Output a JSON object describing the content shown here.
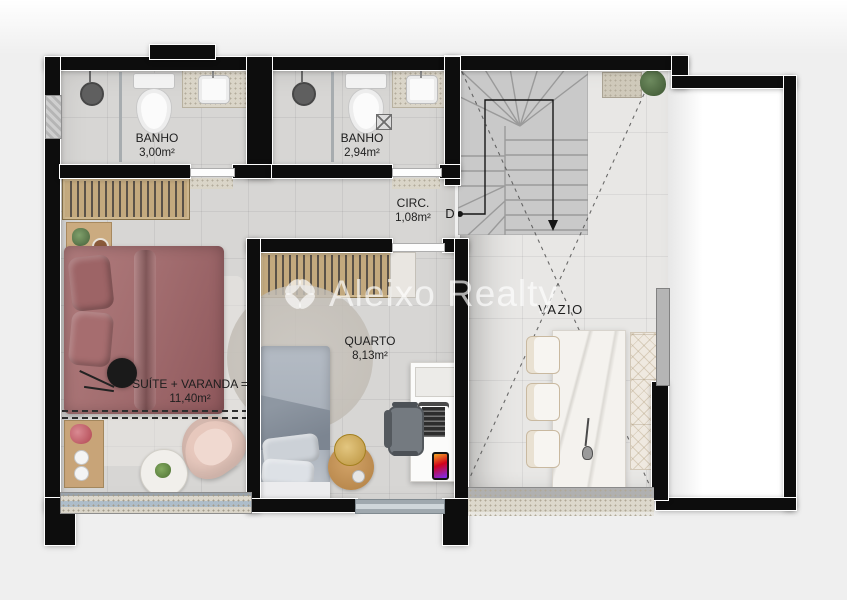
{
  "plan": {
    "watermark": "Aleixo Realty",
    "rooms": {
      "banho1": {
        "name": "BANHO",
        "area": "3,00m²"
      },
      "banho2": {
        "name": "BANHO",
        "area": "2,94m²"
      },
      "circ": {
        "name": "CIRC.",
        "area": "1,08m²"
      },
      "quarto": {
        "name": "QUARTO",
        "area": "8,13m²"
      },
      "suite": {
        "name": "SUÍTE + VARANDA =",
        "area": "11,40m²"
      },
      "vazio": {
        "name": "VAZIO"
      }
    },
    "stairs": {
      "direction_label": "D"
    },
    "colors": {
      "wall": "#0d0d0d",
      "floor": "#d7d6d4",
      "void_floor": "#e8e7e5",
      "suite_bed": "#a97476",
      "quarto_bed": "#aab2bc",
      "wood": "#c3a97e",
      "watermark": "rgba(255,255,255,0.66)"
    }
  }
}
